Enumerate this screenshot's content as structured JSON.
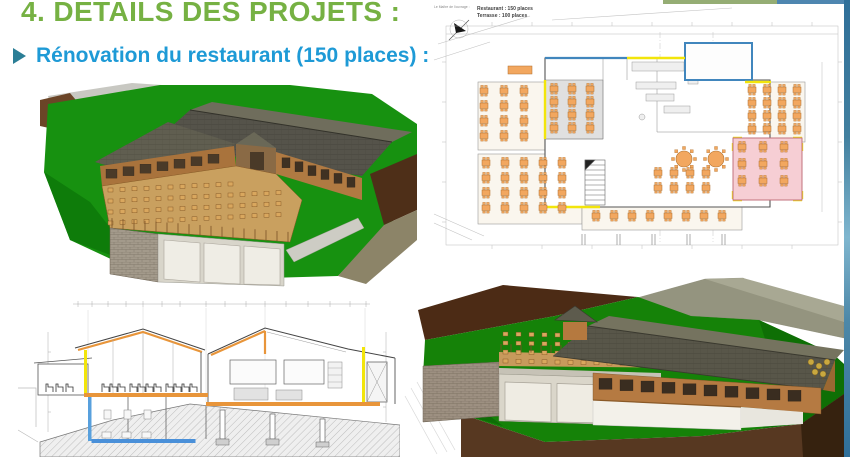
{
  "slide": {
    "title": "4. DETAILS DES PROJETS :",
    "bullet": "Rénovation du restaurant (150 places) :"
  },
  "colors": {
    "title_green": "#76b143",
    "bullet_blue": "#1e9ad6",
    "bullet_arrow_teal": "#2b7e96",
    "top_bar_green": "#95ad74",
    "top_bar_blue": "#4e86b0",
    "right_strip_blue": "#3f7fa8",
    "plan_table_orange": "#f2a75f",
    "plan_room_pink": "#f6ced4",
    "plan_wall_blue": "#4186bd",
    "plan_wall_yellow": "#f2e50b",
    "section_beam_orange": "#e8953a",
    "section_foundation_blue": "#4a90d9",
    "terrain_green": "#179110",
    "earth_brown": "#573821"
  },
  "floor_plan": {
    "owner_label": "Le Maître de l'ouvrage :",
    "legend_line1": "Restaurant : 150 places",
    "legend_line2": "Terrasse : 100 places"
  }
}
